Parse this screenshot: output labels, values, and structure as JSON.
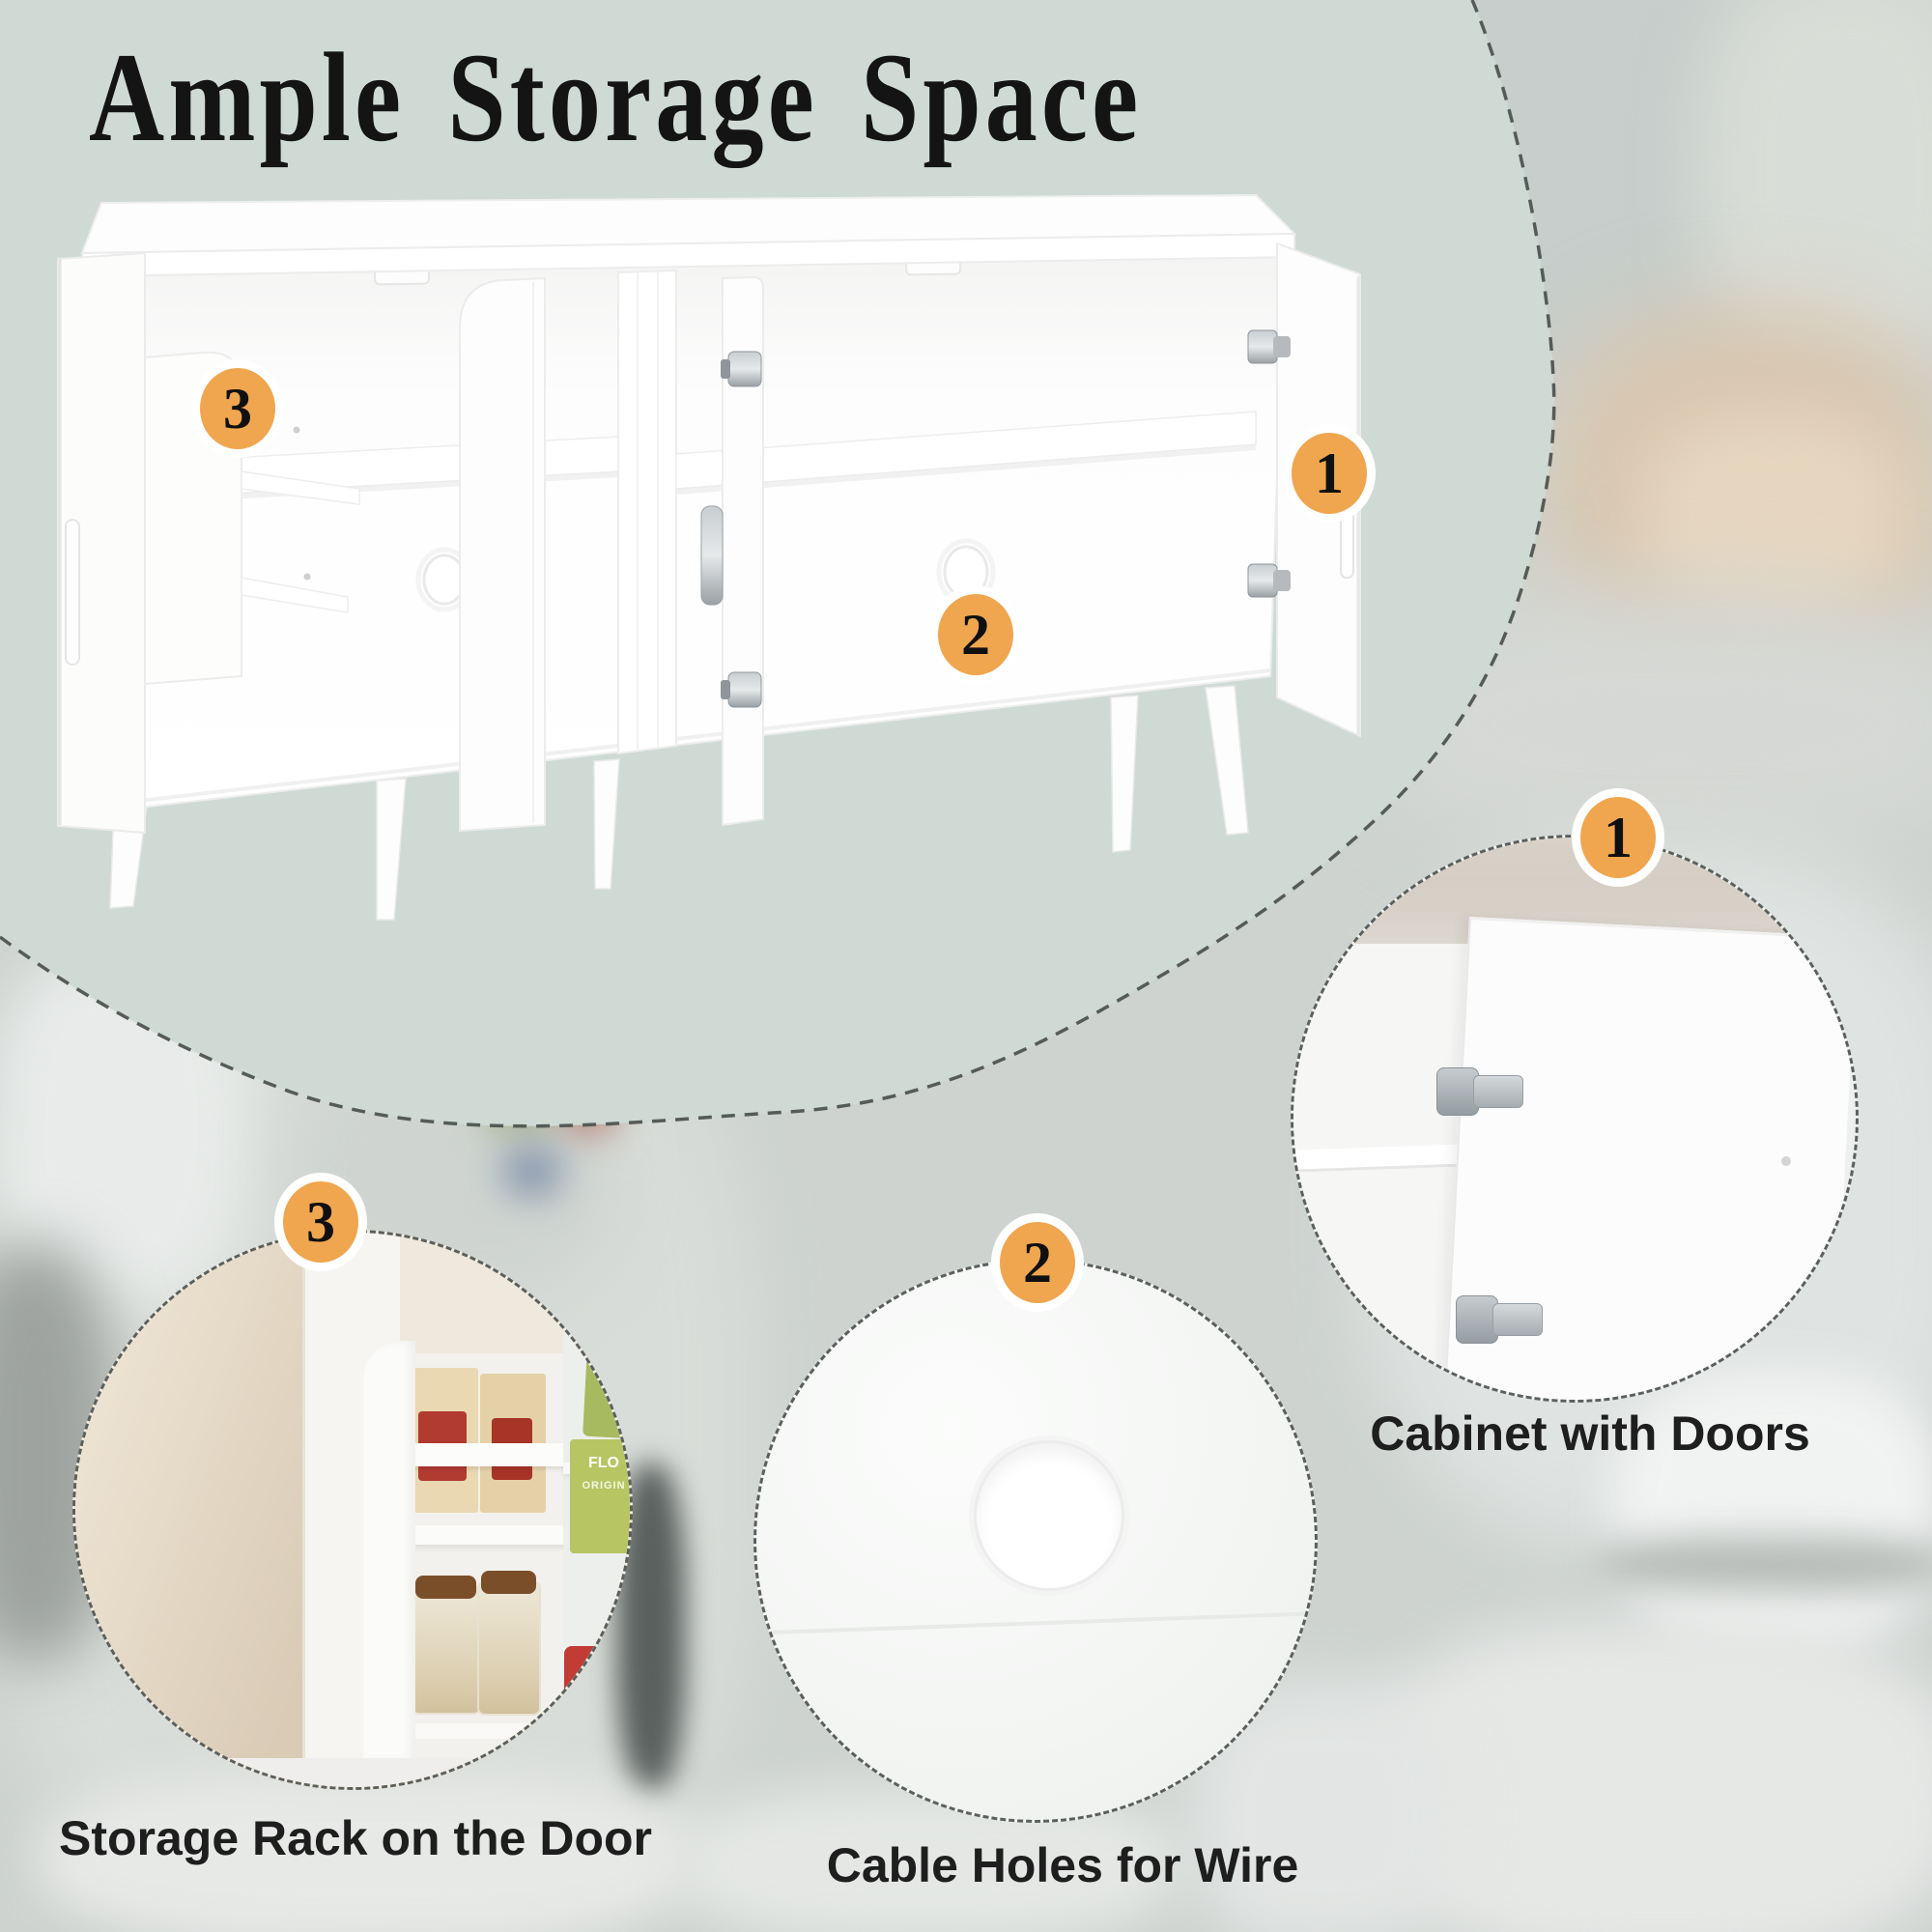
{
  "title": "Ample Storage Space",
  "main_photo": {
    "badges": [
      {
        "number": "3"
      },
      {
        "number": "1"
      },
      {
        "number": "2"
      }
    ]
  },
  "features": [
    {
      "number": "1",
      "caption": "Cabinet with Doors"
    },
    {
      "number": "2",
      "caption": "Cable Holes for Wire"
    },
    {
      "number": "3",
      "caption": "Storage Rack on the Door"
    }
  ],
  "product_labels": {
    "green_box_line1": "FLO",
    "green_box_line2": "ORIGIN",
    "soda_can_line1": "Dr",
    "soda_can_line2": "pper"
  },
  "colors": {
    "accent_orange": "#f0a64f",
    "sage_panel": "#cfdad4",
    "dashed_border": "#5b605d",
    "caption_text": "#1e1e1e",
    "title_text": "#141414"
  }
}
